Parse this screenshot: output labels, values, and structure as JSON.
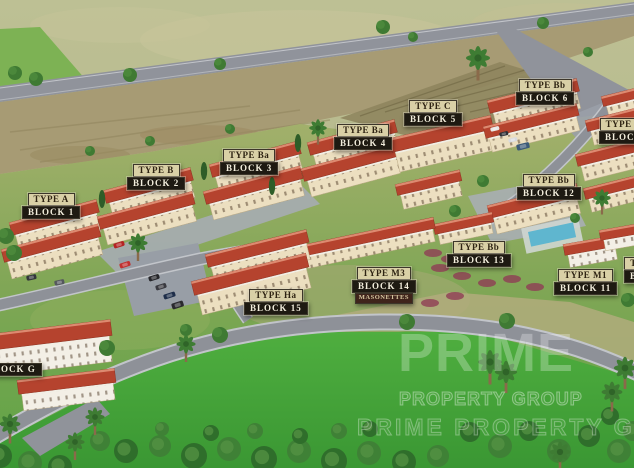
{
  "scene": {
    "description": "Aerial 3D rendering of a residential development site plan with labelled building blocks",
    "labels": [
      {
        "type": "TYPE A",
        "block": "BLOCK 1",
        "x": 22,
        "y": 193
      },
      {
        "type": "TYPE B",
        "block": "BLOCK 2",
        "x": 127,
        "y": 164
      },
      {
        "type": "TYPE Ba",
        "block": "BLOCK 3",
        "x": 220,
        "y": 149
      },
      {
        "type": "TYPE Ba",
        "block": "BLOCK 4",
        "x": 334,
        "y": 124
      },
      {
        "type": "TYPE C",
        "block": "BLOCK 5",
        "x": 404,
        "y": 100
      },
      {
        "type": "TYPE Bb",
        "block": "BLOCK 6",
        "x": 516,
        "y": 79
      },
      {
        "type": "TYPE H",
        "block": "BLOCK",
        "x": 599,
        "y": 118
      },
      {
        "type": "TYPE Bb",
        "block": "BLOCK 12",
        "x": 517,
        "y": 174
      },
      {
        "type": "TYPE Bb",
        "block": "BLOCK 13",
        "x": 447,
        "y": 241
      },
      {
        "type": "TYPE M3",
        "block": "BLOCK 14",
        "note": "MASONETTES",
        "x": 352,
        "y": 267
      },
      {
        "type": "TYPE M1",
        "block": "BLOCK 11",
        "x": 554,
        "y": 269
      },
      {
        "type": "TYPE Ha",
        "block": "BLOCK 15",
        "x": 244,
        "y": 289
      },
      {
        "type": null,
        "block": "BLOCK G",
        "x": -19,
        "y": 363
      },
      {
        "type": "T",
        "block": "B",
        "x": 624,
        "y": 257
      }
    ],
    "watermark": {
      "large": "PRIME",
      "sub": "PROPERTY GROUP",
      "row": "PRIME PROPERTY GROUP"
    },
    "colors": {
      "roof": "#b5432e",
      "roof_light": "#dd8a70",
      "wall": "#ecdfc0",
      "wall_white": "#f3efe6",
      "road": "#8e9198",
      "field": "#b6b98c",
      "scrub": "#a79b74",
      "lawn": "#6aa84a",
      "bright_lawn": "#42a13a",
      "pool": "#5fb6cf",
      "label_tan": "#d9d0a6",
      "label_dark": "#1e1a12",
      "label_note": "#3f241b"
    }
  }
}
